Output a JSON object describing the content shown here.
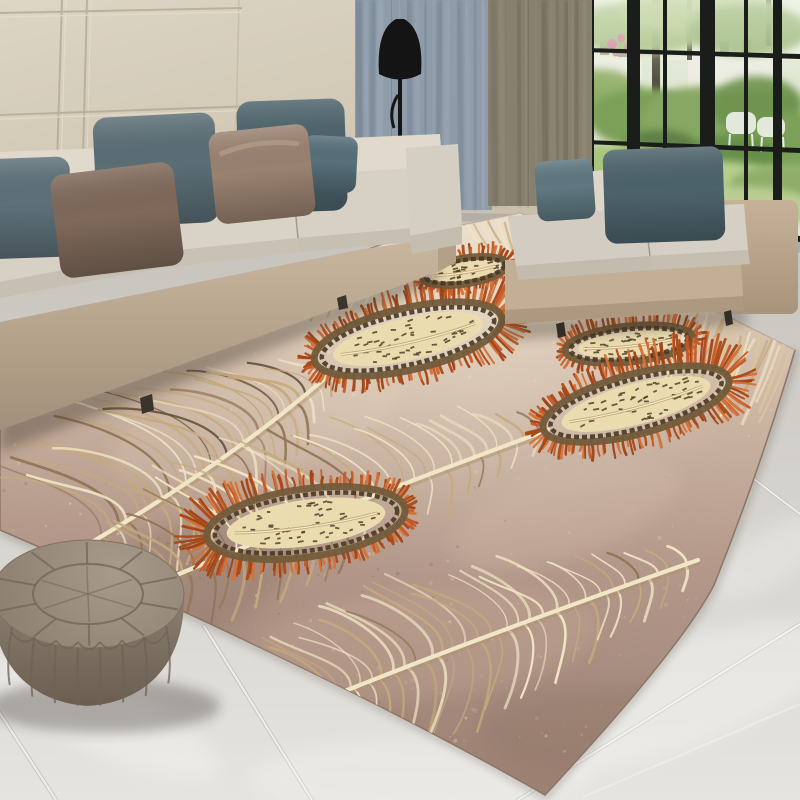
{
  "meta": {
    "type": "interior-photograph",
    "subject": "Feather-pattern area rug in a modern living room",
    "width_px": 800,
    "height_px": 800
  },
  "palette": {
    "wall": "#d8d0bf",
    "wall_line": "#b2a78f",
    "wall_line_light": "#e6dfcd",
    "curtain_blue": "#8e9ba9",
    "curtain_blue_dark": "#69788a",
    "curtain_blue_light": "#a9b4c0",
    "curtain_olive": "#87806f",
    "curtain_olive_dark": "#665f50",
    "curtain_olive_light": "#9c9482",
    "window_frame": "#1b1d1a",
    "garden_light": "#c2d69b",
    "garden_mid": "#86a862",
    "garden_dark": "#5f8046",
    "house_white": "#ecebe2",
    "flower_pink": "#cf869d",
    "floor_back": "#c5c2bb",
    "floor_front": "#e6e4e0",
    "grout": "#efede9",
    "lamp_black": "#141414",
    "sofa_base": "#c3b098",
    "sofa_cushion": "#d7d0c5",
    "sofa_back_cushion": "#e0d9cc",
    "pillow_blue": "#5d7079",
    "pillow_blue_dark": "#4d636c",
    "pillow_blue_light": "#5f7881",
    "pillow_brown": "#7f695a",
    "pillow_taupe": "#9a8270",
    "rug_light": "#e2d5bf",
    "rug_mid": "#b09486",
    "rug_dark": "#96796b",
    "feather_cream": "#f0e3c2",
    "feather_tan": "#c3a678",
    "feather_brown": "#8a6d4d",
    "feather_deep": "#5f4a33",
    "eye_orange": "#c2521c",
    "eye_orange_dark": "#a8410f",
    "eye_orange_light": "#d26a2e",
    "eye_cream": "#eadbad",
    "eye_dark": "#3f3018",
    "eye_ring": "#6b5434",
    "pouf": "#97897a",
    "pouf_dark": "#685d50",
    "shadow": "#2e261e"
  },
  "objects": {
    "wall": {
      "label": "beige paneled wall"
    },
    "curtain_left": {
      "label": "blue-gray curtain"
    },
    "curtain_right": {
      "label": "olive-gray curtain"
    },
    "window": {
      "label": "black framed window",
      "view": "garden with shrubs, trees, white house and white garden chairs"
    },
    "floor_lamp": {
      "label": "black floor lamp"
    },
    "sofa_left": {
      "label": "beige sectional sofa",
      "pillows": 6
    },
    "bench_right": {
      "label": "beige backless sofa bench",
      "pillows": 2
    },
    "rug": {
      "label": "feather print area rug",
      "feathers": 4,
      "feather_eyes": 5,
      "accent": "orange-red"
    },
    "pouf": {
      "label": "round leather pouf"
    },
    "floor": {
      "label": "polished marble tile floor"
    }
  }
}
